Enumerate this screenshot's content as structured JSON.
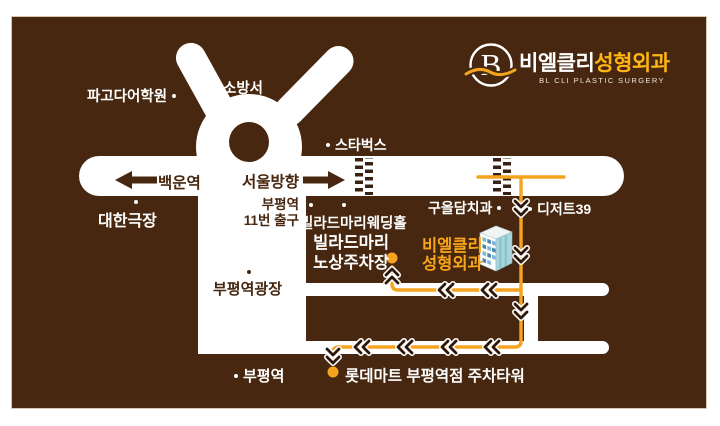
{
  "logo": {
    "mark_letter": "B",
    "name_white": "비엘클리",
    "name_orange": "성형외과",
    "subtitle": "BL CLI PLASTIC SURGERY"
  },
  "road_signs": {
    "left_destination": "백운역",
    "right_destination": "서울방향"
  },
  "locations": {
    "pagoda_academy": "파고다어학원",
    "fire_station": "소방서",
    "starbucks": "스타벅스",
    "daehan_theater": "대한극장",
    "bupyeong_exit": [
      "부평역",
      "11번 출구"
    ],
    "villard_mari_wedding_hall": "빌라드마리웨딩홀",
    "guoldam_dental": "구올담치과",
    "dessert39": "디저트39",
    "villard_mari_parking": [
      "빌라드마리",
      "노상주차장"
    ],
    "clinic": [
      "비엘클리",
      "성형외과"
    ],
    "bupyeong_plaza": "부평역광장",
    "bupyeong_station": "부평역",
    "lotte_mart_parking_tower": "롯데마트 부평역점 주차타워"
  },
  "colors": {
    "background_brown": "#47270F",
    "road_white": "#FFFFFF",
    "route_orange": "#F6A41F",
    "logo_orange": "#FFB612",
    "chevron_dark": "#2E1708"
  },
  "icons": {
    "logo_mark": "circle-B-with-wave",
    "left_arrow": "←",
    "right_arrow": "→",
    "location_dot": "•",
    "route_chevron": "«",
    "building": "clinic-building"
  }
}
